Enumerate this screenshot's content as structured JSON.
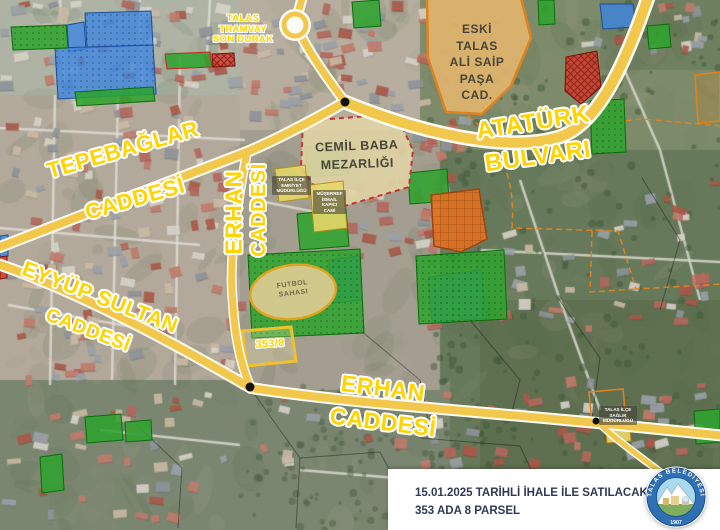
{
  "map": {
    "labels": {
      "tram_stop": {
        "lines": [
          "TALAS",
          "TRAMVAY",
          "SON DURAK"
        ]
      },
      "eski_talas": {
        "lines": [
          "ESKİ",
          "TALAS",
          "ALİ SAİP",
          "PAŞA",
          "CAD."
        ]
      },
      "ataturk_bulvari": {
        "line1": "ATATÜRK",
        "line2": "BULVARI"
      },
      "tepebaglar_caddesi": {
        "line1": "TEPEBAĞLAR",
        "line2": "CADDESİ"
      },
      "erhan_caddesi_vertical": {
        "line1": "ERHAN",
        "line2": "CADDESİ"
      },
      "eyyup_sultan_caddesi": {
        "line1": "EYYÜP SULTAN",
        "line2": "CADDESİ"
      },
      "erhan_caddesi_bottom": {
        "line1": "ERHAN",
        "line2": "CADDESİ"
      },
      "cemil_baba": {
        "line1": "CEMİL BABA",
        "line2": "MEZARLIĞI"
      },
      "futbol_sahasi": {
        "line1": "FUTBOL",
        "line2": "SAHASI"
      },
      "parcel_code": "353/8",
      "police": {
        "lines": [
          "TALAS İLÇE",
          "EMNİYET",
          "MÜDÜRLÜĞÜ"
        ]
      },
      "mosque": {
        "lines": [
          "MÜŞERREF",
          "İSMAİL",
          "KAPICI",
          "CAMİ"
        ]
      },
      "health": {
        "lines": [
          "TALAS İLÇE",
          "SAĞLIK",
          "MÜDÜRLÜĞÜ"
        ]
      }
    },
    "colors": {
      "label_yellow": "#ffd400",
      "road_fill": "#f1c84b",
      "road_casing": "#fbfbf5",
      "parcel_blue": "#3f86e0",
      "parcel_green": "#2da32d",
      "parcel_red": "#d13a2a",
      "parcel_orange": "#e2701f",
      "parcel_tan": "#dfb46e",
      "parcel_yellow": "#e6d76a",
      "cemetery_fill": "#ded2a4",
      "boundary_orange": "#e0821e"
    }
  },
  "footer": {
    "line1": "15.01.2025 TARİHLİ İHALE İLE SATILACAK PARSEL",
    "line2": "353 ADA 8 PARSEL"
  },
  "logo": {
    "organization": "TALAS BELEDİYESİ",
    "year": "1907"
  }
}
